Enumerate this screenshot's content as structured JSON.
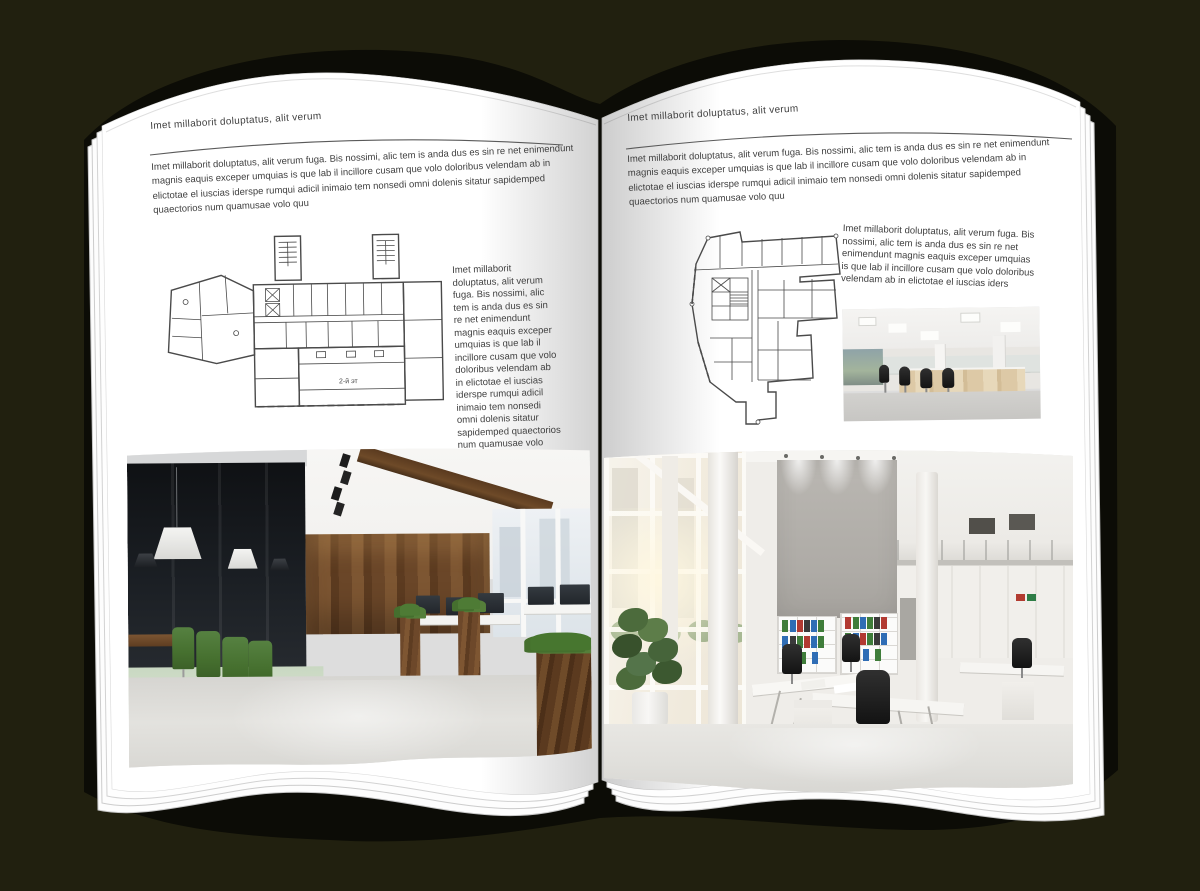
{
  "background_color": "#21200f",
  "left_page": {
    "header": "Imet millaborit doluptatus, alit verum",
    "intro": "Imet millaborit doluptatus, alit verum fuga. Bis nossimi, alic tem is anda dus es sin re net enimendunt magnis eaquis exceper umquias is que lab il incillore cusam que volo doloribus velendam ab in elictotae el iuscias iderspe rumqui adicil inimaio tem nonsedi omni dolenis sitatur sapidemped quaectorios num quamusae volo quu",
    "side_text": "Imet millaborit doluptatus, alit verum fuga. Bis nossimi, alic tem is anda dus es sin re net enimendunt magnis eaquis exceper umquias is que lab il incillore cusam que volo doloribus velendam ab in elictotae el iuscias iderspe rumqui adicil inimaio tem nonsedi omni dolenis sitatur sapidemped quaectorios num quamusae volo quu",
    "plan_label": "2-й эт"
  },
  "right_page": {
    "header": "Imet millaborit doluptatus, alit verum",
    "intro": "Imet millaborit doluptatus, alit verum fuga. Bis nossimi, alic tem is anda dus es sin re net enimendunt magnis eaquis exceper umquias is que lab il incillore cusam que volo doloribus velendam ab in elictotae el iuscias iderspe rumqui adicil inimaio tem nonsedi omni dolenis sitatur sapidemped quaectorios num quamusae volo quu",
    "side_text": "Imet millaborit doluptatus, alit verum fuga. Bis nossimi, alic tem is anda dus es sin re net enimendunt magnis eaquis exceper umquias is que lab il incillore cusam que volo doloribus velendam ab in elictotae el iuscias iders"
  },
  "figures": {
    "left_floorplan": "rectangular-office-floor-plan",
    "right_floorplan": "irregular-office-floor-plan",
    "left_large_photo": "dark-wood-loft-office-interior",
    "right_small_photo": "white-open-plan-office",
    "right_large_photo": "atrium-office-with-concrete-wall"
  },
  "colors": {
    "page": "#ffffff",
    "text": "#3f3f3f",
    "wood": "#6a4628",
    "chair_green": "#4e7539",
    "plant_green": "#4c6b3c",
    "binder_blue": "#2f6db5",
    "binder_green": "#3f7d3a",
    "binder_red": "#b23a32"
  }
}
